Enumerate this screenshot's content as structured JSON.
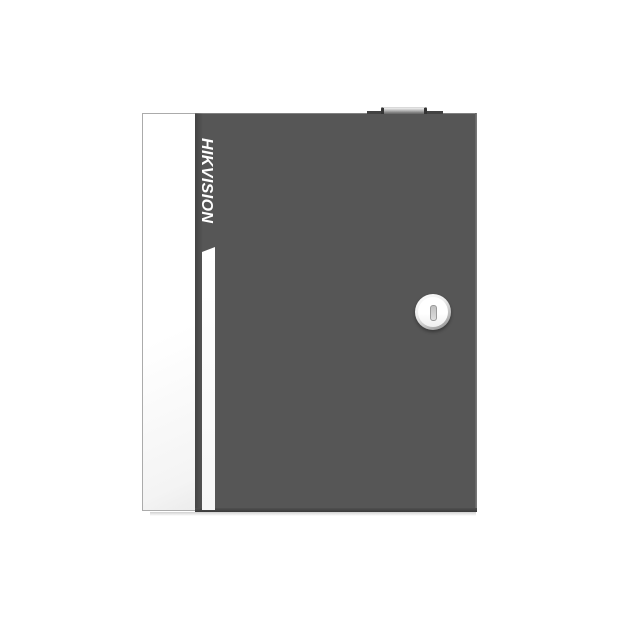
{
  "scene": {
    "type": "product-photo",
    "subject": "Wall-mount metal enclosure with front door, key lock and top knob",
    "background_color": "#ffffff"
  },
  "device": {
    "brand_logo": "HIKVISION",
    "colors": {
      "door_gray": "#565656",
      "side_panel_white": "#ffffff",
      "accent_stripe_white": "#fbfbfb",
      "logo_white": "#ffffff",
      "lock_face_silver": "#f6f6f6",
      "keyhole_slot_gray": "#cfcfcf",
      "top_knob_gray": "#c2c2c2",
      "bottom_edge_dark": "#3a3a3a"
    }
  }
}
